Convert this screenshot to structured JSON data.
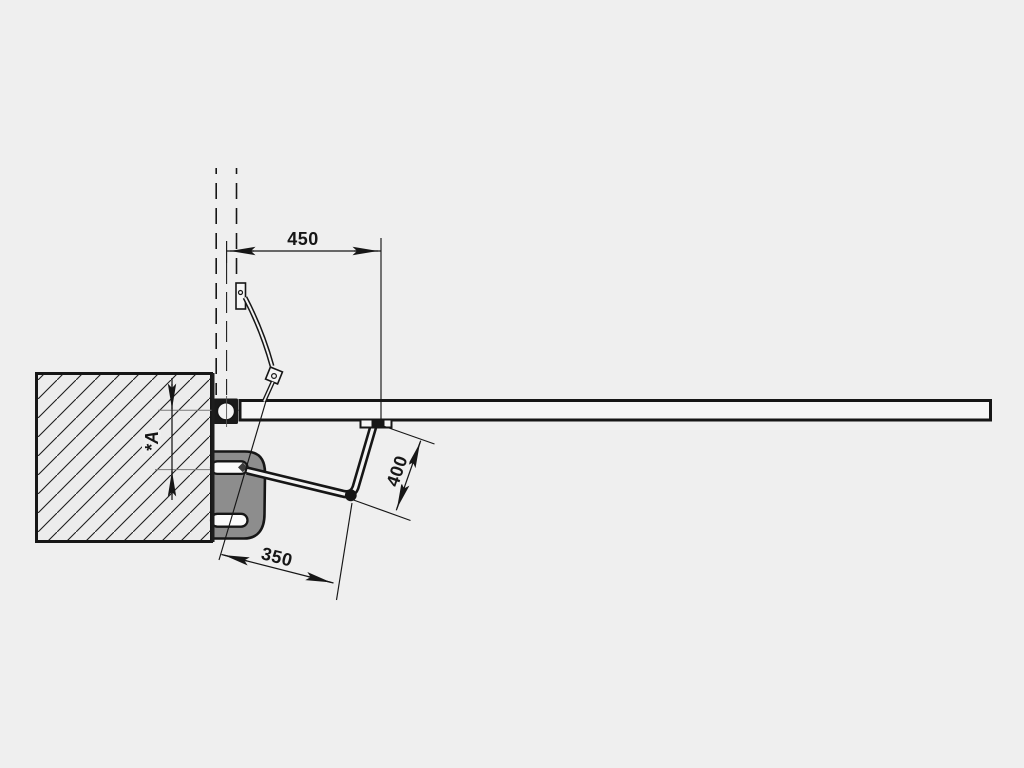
{
  "title": "Articulated-arm swing gate operator installation drawing (top view)",
  "colors": {
    "bg": "#efefef",
    "ink": "#161616",
    "motor": "#8d8d8d",
    "hatch": "#1d1d1d",
    "ref": "#7a7a7a"
  },
  "dimensions": {
    "hinge_to_arm_bracket": "450",
    "arm_segment_length": "400",
    "axis_to_elbow": "350",
    "pillar_setback": "*A"
  }
}
